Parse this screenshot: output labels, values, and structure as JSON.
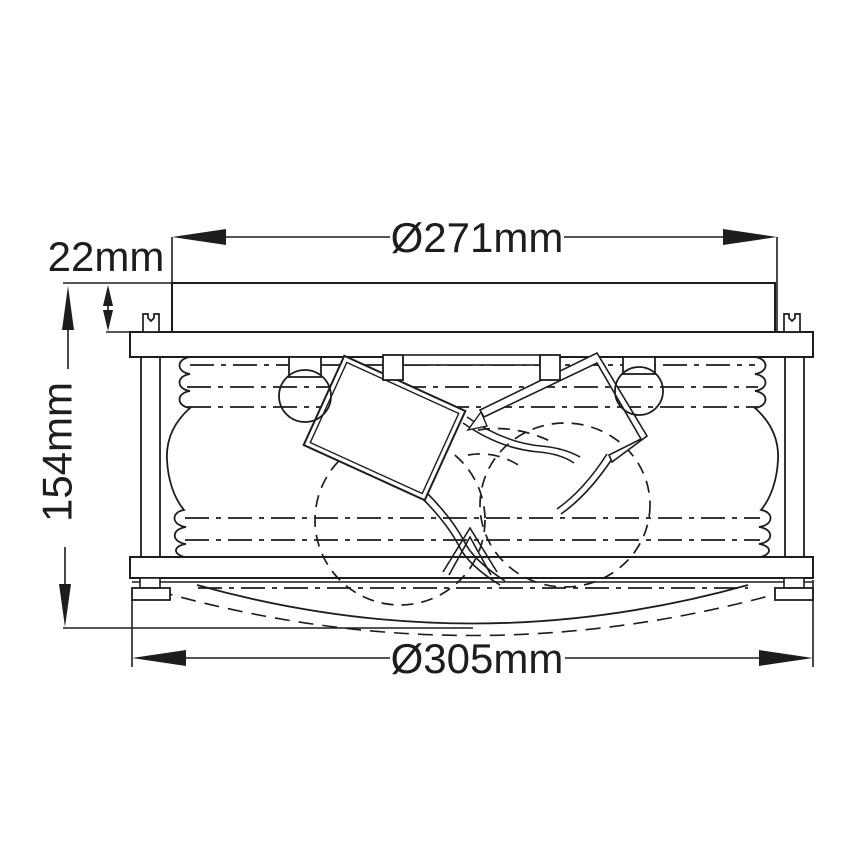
{
  "title": "Flush-mount ceiling light fixture dimensional drawing",
  "labels": {
    "top_diameter": "Ø271mm",
    "canopy_height": "22mm",
    "fixture_height": "154mm",
    "base_diameter": "Ø305mm"
  },
  "dimensions": [
    {
      "name": "canopy diameter",
      "label": "Ø271mm",
      "value": 271,
      "unit": "mm",
      "axis": "horizontal",
      "location": "top"
    },
    {
      "name": "canopy height",
      "label": "22mm",
      "value": 22,
      "unit": "mm",
      "axis": "vertical",
      "location": "upper-left"
    },
    {
      "name": "overall height",
      "label": "154mm",
      "value": 154,
      "unit": "mm",
      "axis": "vertical",
      "location": "left"
    },
    {
      "name": "outer ring diameter",
      "label": "Ø305mm",
      "value": 305,
      "unit": "mm",
      "axis": "horizontal",
      "location": "bottom"
    }
  ],
  "colors": {
    "background": "#ffffff",
    "line": "#1d1d1d"
  }
}
